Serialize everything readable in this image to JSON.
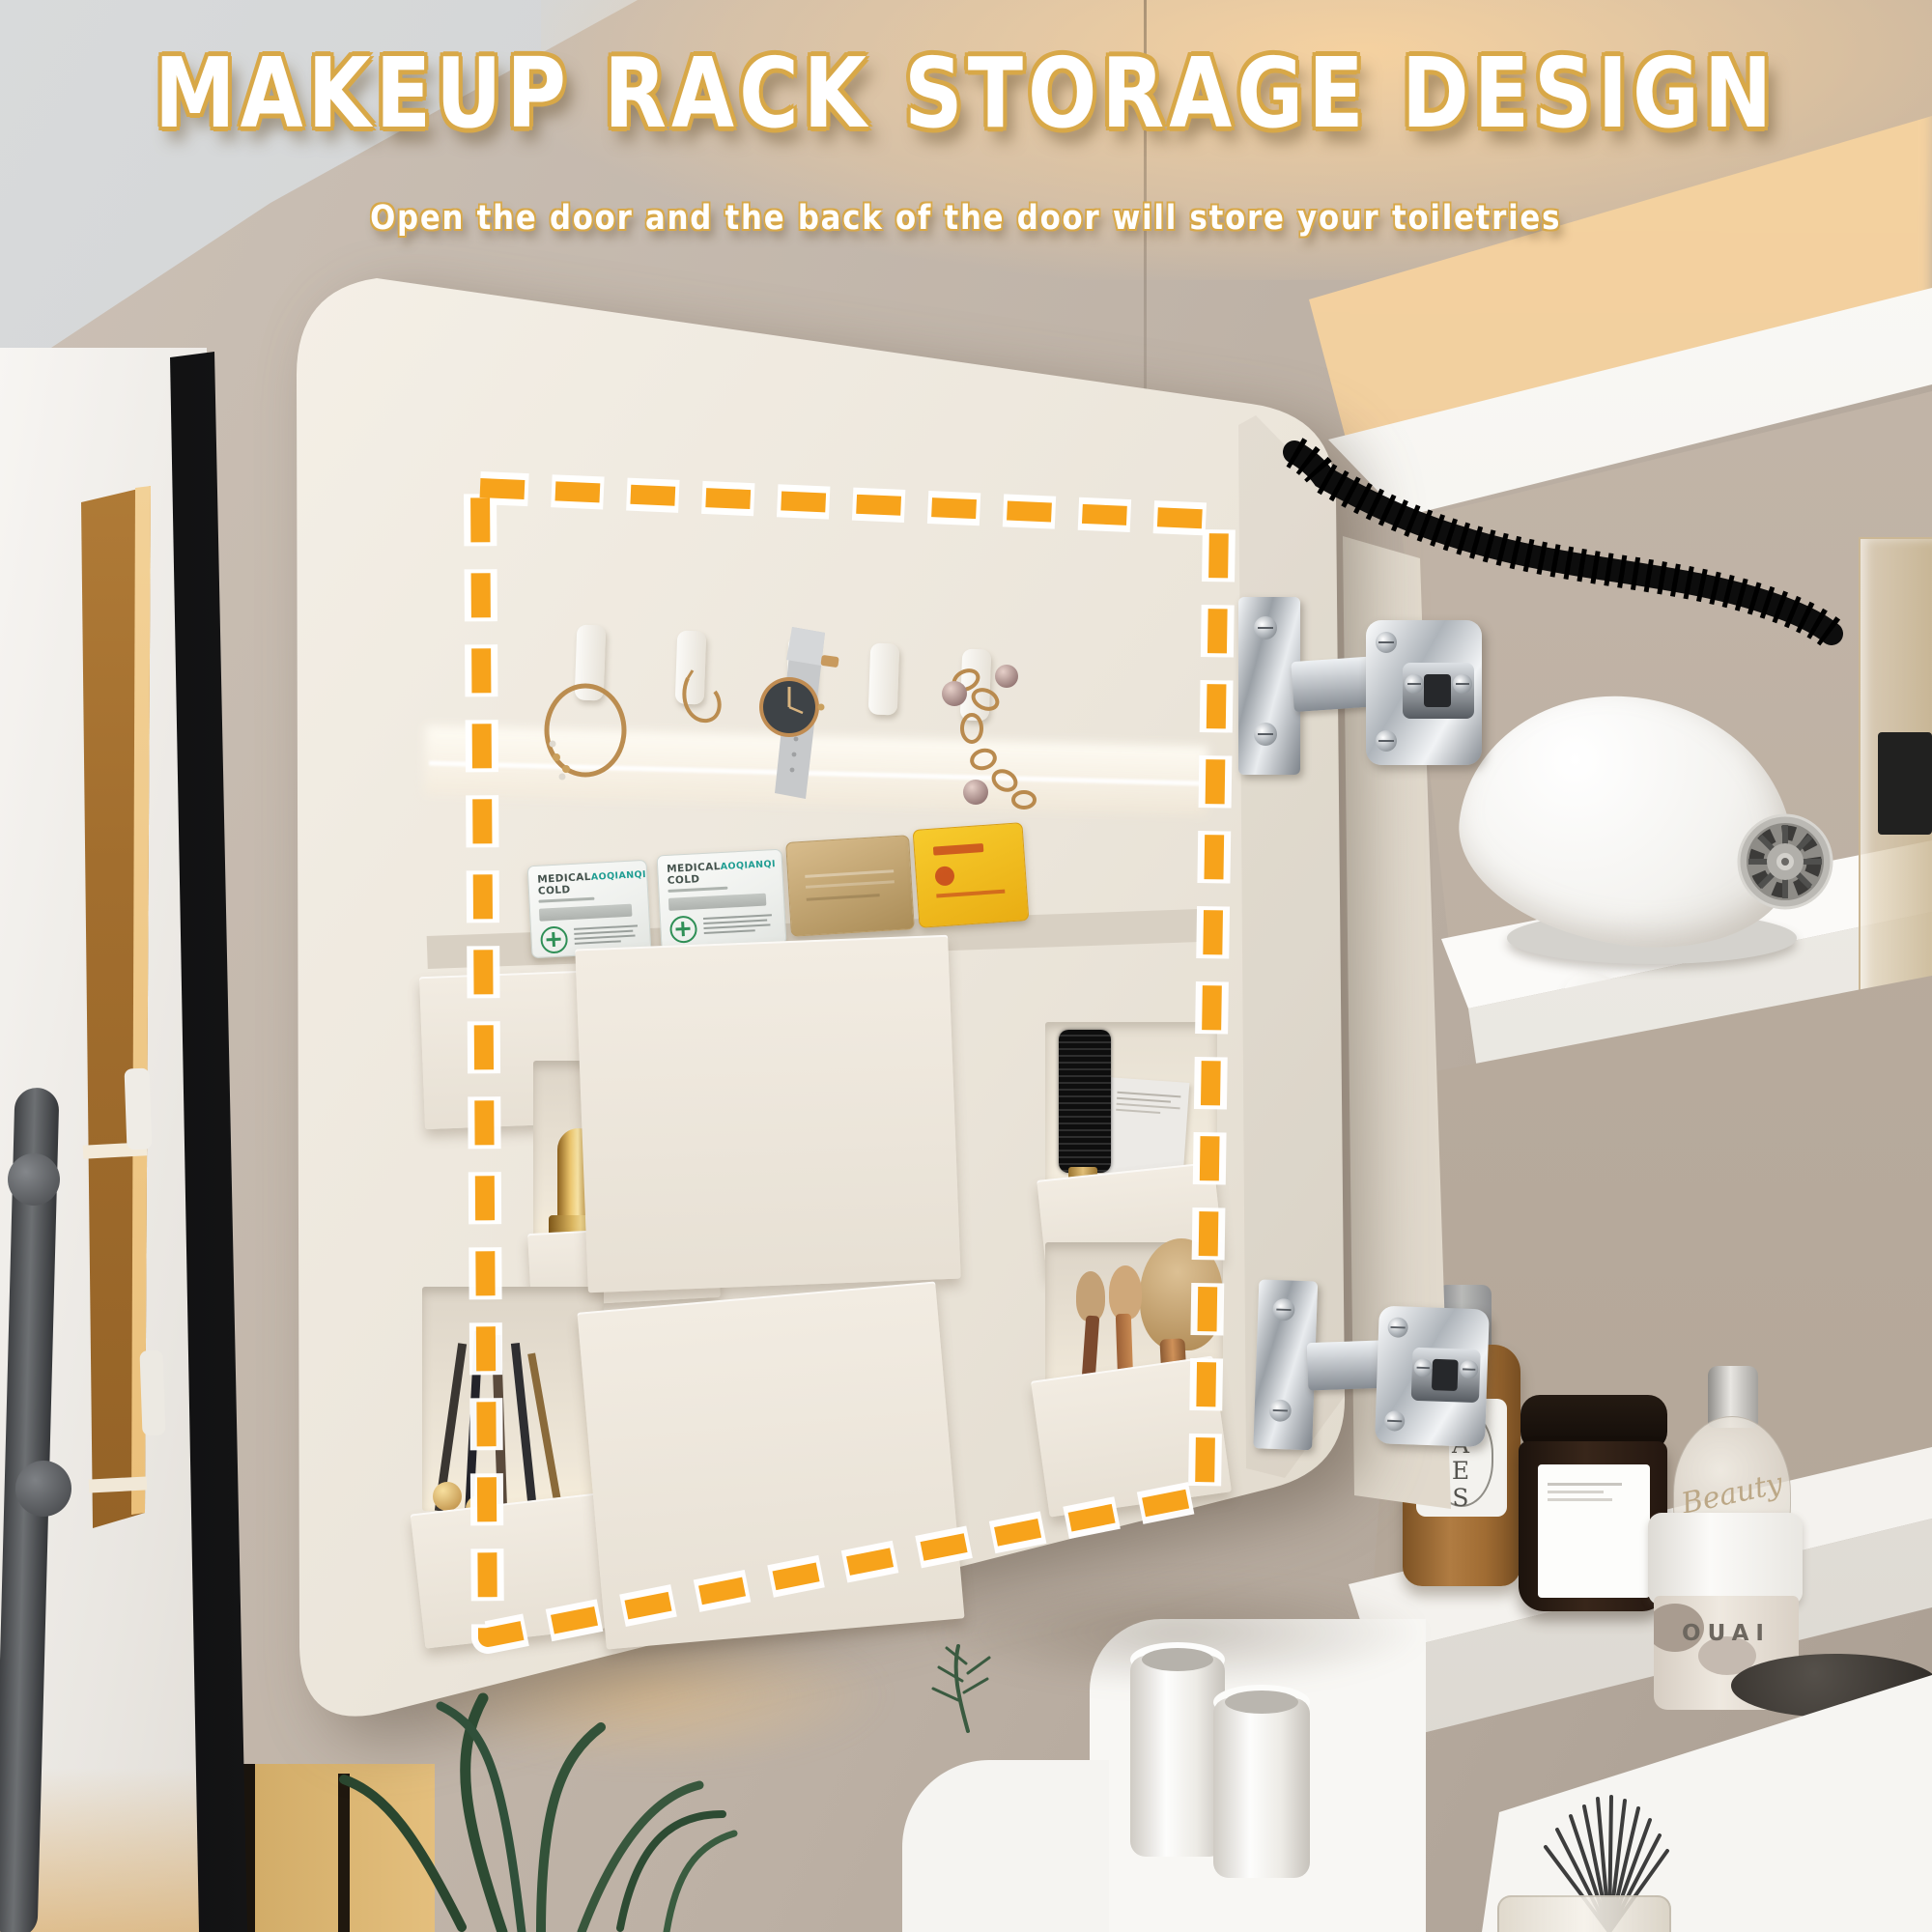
{
  "header": {
    "title": "MAKEUP RACK STORAGE DESIGN",
    "subtitle": "Open the door and the back of the door will store your toiletries"
  },
  "door_storage": {
    "hook_row": {
      "hooks": 5,
      "items": [
        "gold bangle bracelet",
        "gold hoop earring",
        "grey leather wrist watch",
        "empty hook",
        "gold chain bracelet with pearls"
      ]
    },
    "mask_packets": [
      {
        "name": "MEDICAL COLD",
        "brand": "AOQIANQI",
        "color": "#f3f4f2"
      },
      {
        "name": "MEDICAL COLD",
        "brand": "AOQIANQI",
        "color": "#f3f4f2"
      },
      {
        "name": "",
        "brand": "",
        "color": "#c3a776"
      },
      {
        "name": "",
        "brand": "",
        "color": "#f2c026"
      }
    ],
    "pockets": [
      "empty pocket",
      "gold lipsticks",
      "eyeliner pencils",
      "large flat pocket",
      "large flat pocket",
      "round hair brush and card",
      "makeup brushes"
    ]
  },
  "cabinet_shelves": {
    "top_shelf": [
      "hair dryer",
      "acrylic storage box"
    ],
    "bottle_shelf": [
      {
        "label": "BAES",
        "type": "brown bottle"
      },
      {
        "label": "",
        "type": "dark cream jar"
      },
      {
        "label": "Beauty",
        "type": "glass perfume bottle"
      },
      {
        "label": "OUAI",
        "type": "white marble jar"
      }
    ],
    "counter": [
      "two white cups",
      "fan makeup brush in glass"
    ]
  },
  "colors": {
    "dash_highlight": "#F7A31B",
    "dash_halo": "#FFFFFF",
    "gold_outline": "#D8A848",
    "wall": "#BFB2A6",
    "door": "#EDE7DD"
  }
}
